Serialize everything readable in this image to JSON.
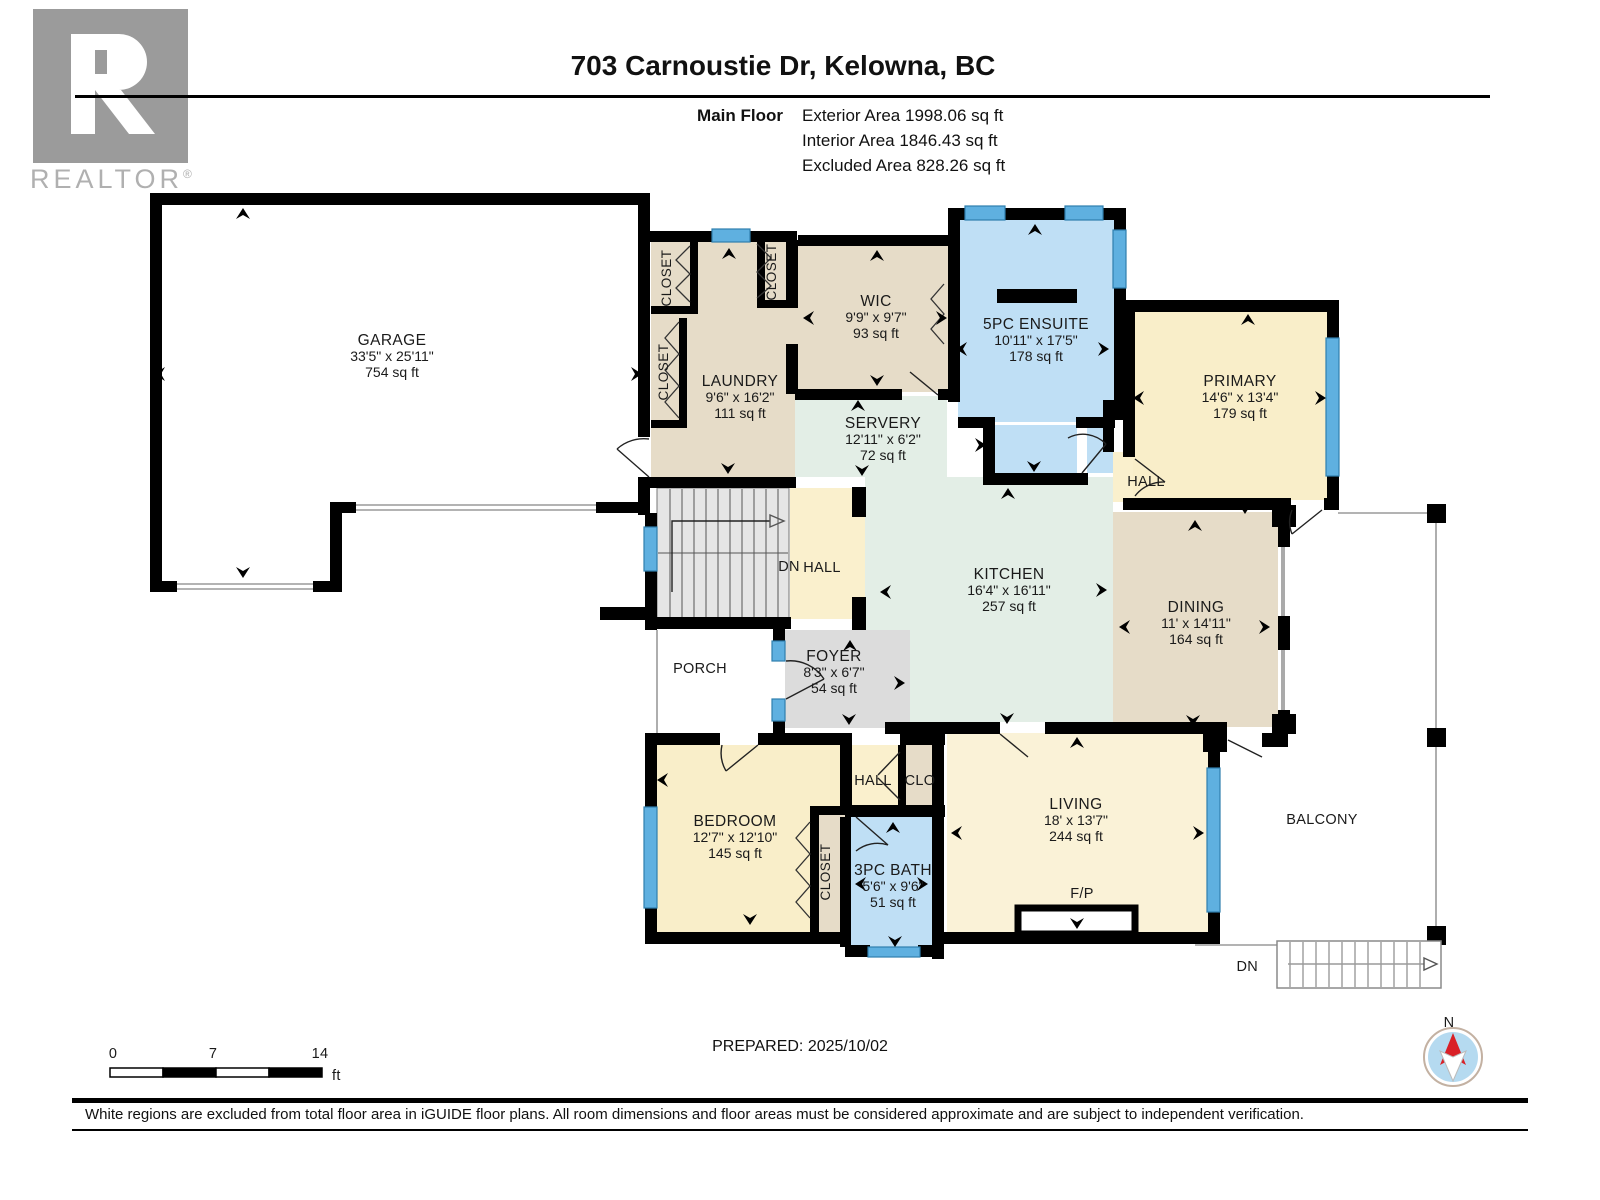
{
  "header": {
    "logo_text": "REALTOR",
    "logo_reg": "®",
    "title": "703 Carnoustie Dr, Kelowna, BC",
    "floor_label": "Main Floor",
    "exterior_area": "Exterior Area 1998.06 sq ft",
    "interior_area": "Interior Area 1846.43 sq ft",
    "excluded_area": "Excluded Area 828.26 sq ft"
  },
  "rooms": {
    "garage": {
      "name": "GARAGE",
      "dims": "33'5\" x 25'11\"",
      "area": "754 sq ft"
    },
    "laundry": {
      "name": "LAUNDRY",
      "dims": "9'6\" x 16'2\"",
      "area": "111 sq ft"
    },
    "wic": {
      "name": "WIC",
      "dims": "9'9\" x 9'7\"",
      "area": "93 sq ft"
    },
    "servery": {
      "name": "SERVERY",
      "dims": "12'11\" x 6'2\"",
      "area": "72 sq ft"
    },
    "ensuite": {
      "name": "5PC ENSUITE",
      "dims": "10'11\" x 17'5\"",
      "area": "178 sq ft"
    },
    "primary": {
      "name": "PRIMARY",
      "dims": "14'6\" x 13'4\"",
      "area": "179 sq ft"
    },
    "kitchen": {
      "name": "KITCHEN",
      "dims": "16'4\" x 16'11\"",
      "area": "257 sq ft"
    },
    "dining": {
      "name": "DINING",
      "dims": "11' x 14'11\"",
      "area": "164 sq ft"
    },
    "foyer": {
      "name": "FOYER",
      "dims": "8'3\" x 6'7\"",
      "area": "54 sq ft"
    },
    "bedroom": {
      "name": "BEDROOM",
      "dims": "12'7\" x 12'10\"",
      "area": "145 sq ft"
    },
    "bath": {
      "name": "3PC BATH",
      "dims": "5'6\" x 9'6\"",
      "area": "51 sq ft"
    },
    "living": {
      "name": "LIVING",
      "dims": "18' x 13'7\"",
      "area": "244 sq ft"
    }
  },
  "labels": {
    "closet": "CLOSET",
    "hall": "HALL",
    "dn": "DN",
    "clo": "CLO",
    "porch": "PORCH",
    "balcony": "BALCONY",
    "fireplace": "F/P",
    "north": "N"
  },
  "scale_bar": {
    "tick_0": "0",
    "tick_7": "7",
    "tick_14": "14",
    "unit": "ft"
  },
  "footer": {
    "prepared": "PREPARED: 2025/10/02",
    "disclaimer": "White regions are excluded from total floor area in iGUIDE floor plans. All room dimensions and floor areas must be considered approximate and are subject to independent verification."
  },
  "colors": {
    "room_tan": "#e6dcc8",
    "room_green": "#e3eee6",
    "room_blue": "#bfdff5",
    "room_cream": "#faf0cd",
    "room_gray": "#dcdcdc",
    "stair_gray": "#e5e5e5",
    "window_blue": "#5fb0e0",
    "wall_black": "#000000",
    "compass_red": "#d92027",
    "compass_blue": "#b5daf0",
    "logo_gray": "#9b9b9b"
  }
}
